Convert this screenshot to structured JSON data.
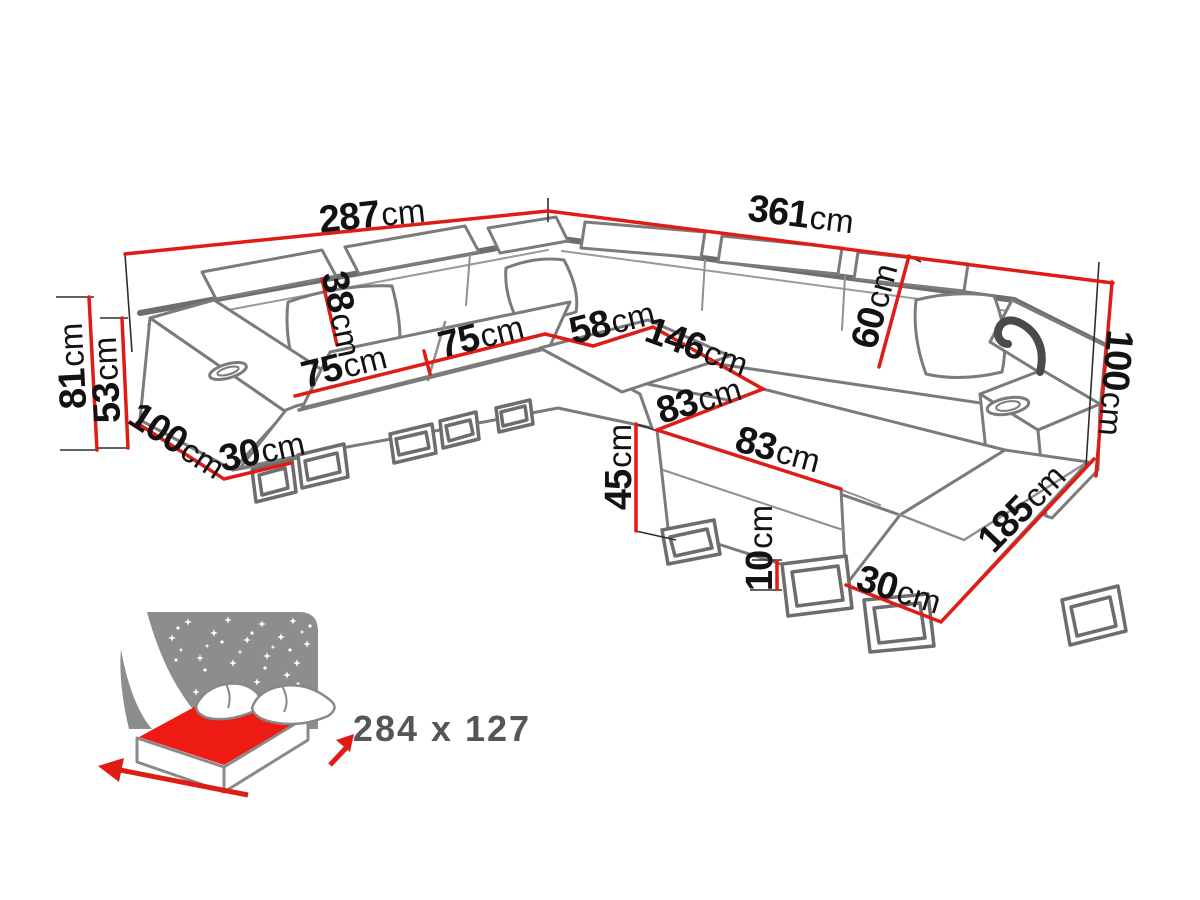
{
  "diagram": {
    "type": "furniture-dimension-diagram",
    "subject": "u-shaped-corner-sofa",
    "unit_default": "cm"
  },
  "dimensions": {
    "total_width_left": {
      "value": "287",
      "unit": "cm"
    },
    "total_width_right": {
      "value": "361",
      "unit": "cm"
    },
    "back_height_left": {
      "value": "81",
      "unit": "cm"
    },
    "seat_height_left": {
      "value": "53",
      "unit": "cm"
    },
    "armrest_depth_left": {
      "value": "100",
      "unit": "cm"
    },
    "armrest_width_left": {
      "value": "30",
      "unit": "cm"
    },
    "back_cushion_height": {
      "value": "38",
      "unit": "cm"
    },
    "seat_width_1": {
      "value": "75",
      "unit": "cm"
    },
    "seat_width_2": {
      "value": "75",
      "unit": "cm"
    },
    "corner_seat_width": {
      "value": "58",
      "unit": "cm"
    },
    "chaise_length": {
      "value": "146",
      "unit": "cm"
    },
    "chaise_width_1": {
      "value": "83",
      "unit": "cm"
    },
    "chaise_width_2": {
      "value": "83",
      "unit": "cm"
    },
    "backrest_height_right": {
      "value": "60",
      "unit": "cm"
    },
    "total_height_right": {
      "value": "100",
      "unit": "cm"
    },
    "front_height": {
      "value": "45",
      "unit": "cm"
    },
    "leg_height": {
      "value": "10",
      "unit": "cm"
    },
    "base_width_right": {
      "value": "30",
      "unit": "cm"
    },
    "total_depth_right": {
      "value": "185",
      "unit": "cm"
    }
  },
  "sleeping_function": {
    "icon": "bed-with-starry-night-icon",
    "size_label": "284 x 127"
  },
  "colors": {
    "dimension_line": "#df1c15",
    "sketch_gray": "#7b7b7b",
    "label_text": "#121212",
    "icon_gray": "#8d8d8d",
    "mattress_red": "#ee1b15",
    "size_text": "#565656"
  }
}
